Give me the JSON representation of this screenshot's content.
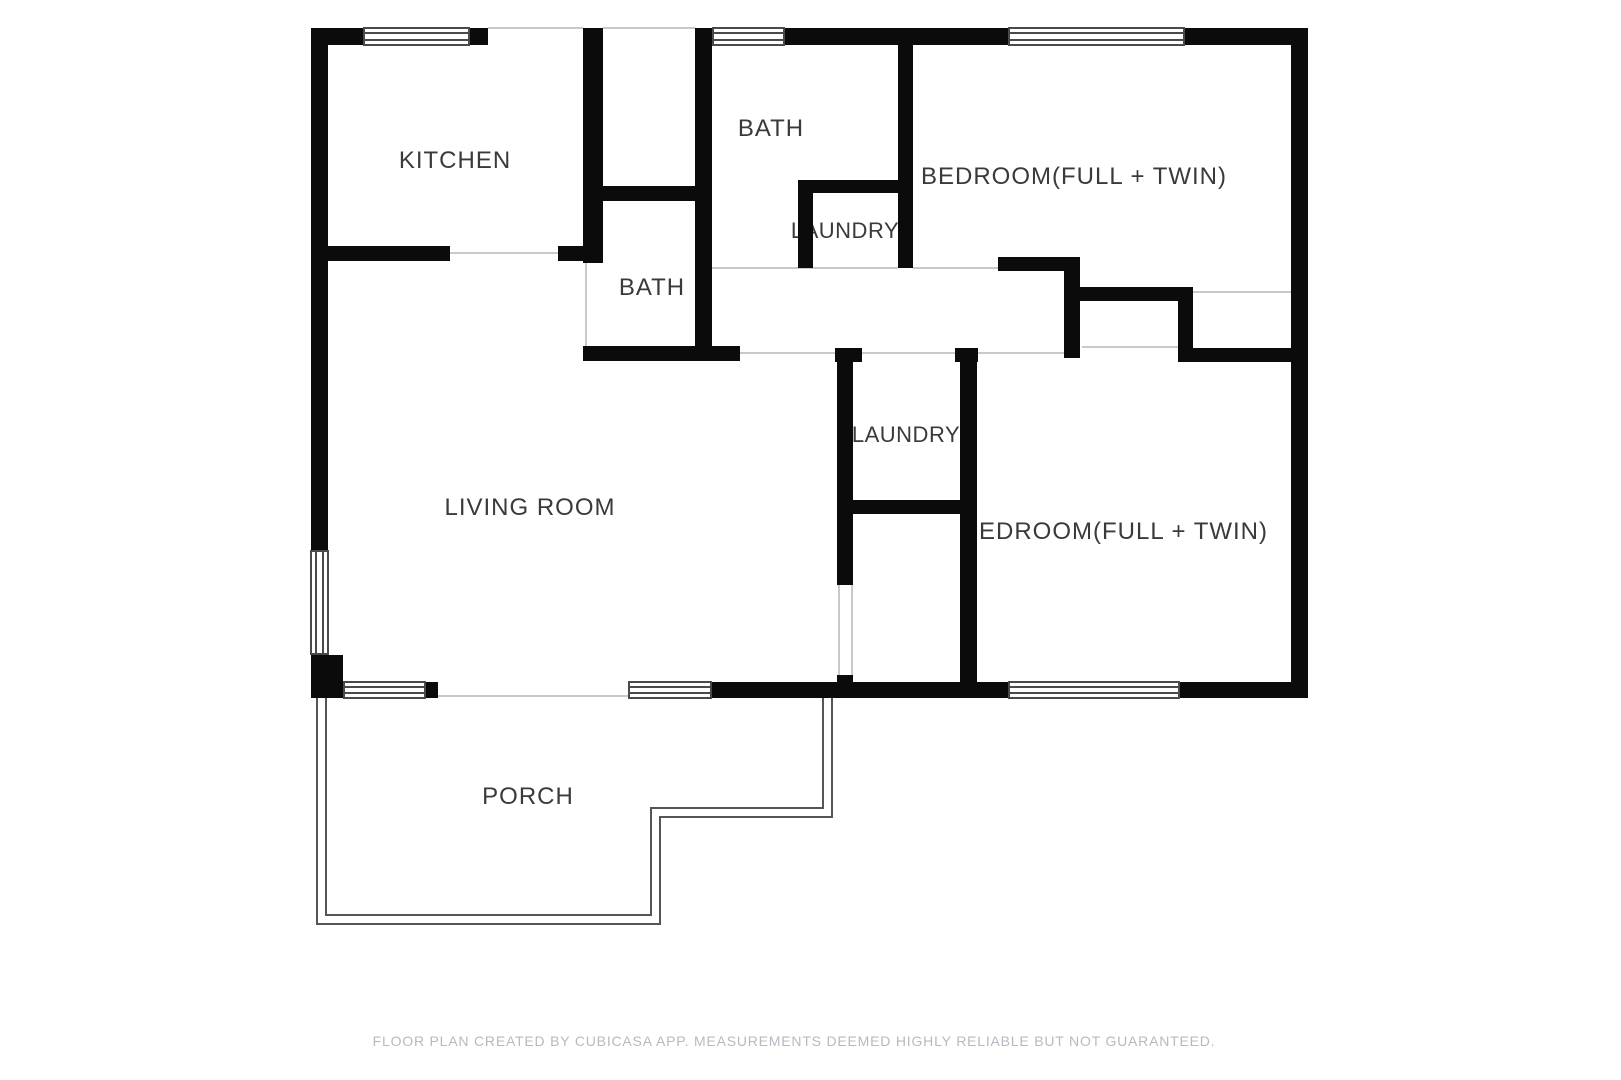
{
  "title": "Floor plan",
  "rooms": {
    "kitchen": {
      "label": "KITCHEN"
    },
    "bath_top": {
      "label": "BATH"
    },
    "bedroom_top": {
      "label": "BEDROOM(FULL + TWIN)"
    },
    "laundry_top": {
      "label": "LAUNDRY"
    },
    "bath_mid": {
      "label": "BATH"
    },
    "laundry_mid": {
      "label": "LAUNDRY"
    },
    "living_room": {
      "label": "LIVING ROOM"
    },
    "bedroom_right": {
      "label": "BEDROOM(FULL + TWIN)"
    },
    "porch": {
      "label": "PORCH"
    }
  },
  "footer": {
    "text": "FLOOR PLAN CREATED BY CUBICASA APP. MEASUREMENTS DEEMED HIGHLY RELIABLE BUT NOT GUARANTEED."
  },
  "colors": {
    "wall": "#0b0b0b",
    "label": "#3a3a3a",
    "footer_text": "#b6bac0",
    "window_frame": "#4a4a4a",
    "opening_line": "#c9c9c9"
  }
}
